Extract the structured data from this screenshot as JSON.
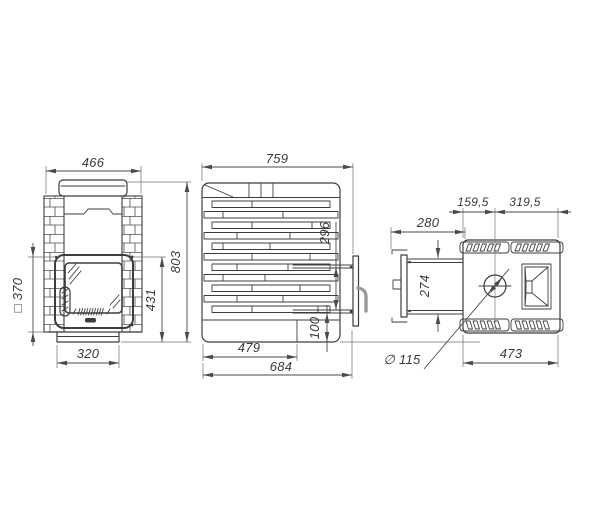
{
  "meta": {
    "type": "technical-drawing",
    "subject": "wood-burning sauna stove, three orthographic views with dimensions"
  },
  "colors": {
    "line": "#3d3d3d",
    "dimension": "#4a4a4a",
    "extension": "#6f6f6f",
    "handle": "#9a9a9a",
    "background": "#ffffff"
  },
  "views": {
    "front": {
      "label": "front-view",
      "dims": {
        "overall_width": "466",
        "door_square": "□ 370",
        "overall_height": "803",
        "door_top_to_floor": "431",
        "base_width": "320"
      }
    },
    "side": {
      "label": "side-view",
      "dims": {
        "overall_depth": "759",
        "tunnel_height": "296",
        "tunnel_bottom_to_floor": "100",
        "base_depth": "479",
        "depth_with_door_frame": "684"
      }
    },
    "top": {
      "label": "top-view",
      "dims": {
        "front_wall_to_chimney_axis": "159,5",
        "chimney_axis_to_back": "319,5",
        "tunnel_length": "280",
        "tunnel_width": "274",
        "chimney_diameter": "∅ 115",
        "body_width": "473"
      }
    }
  }
}
